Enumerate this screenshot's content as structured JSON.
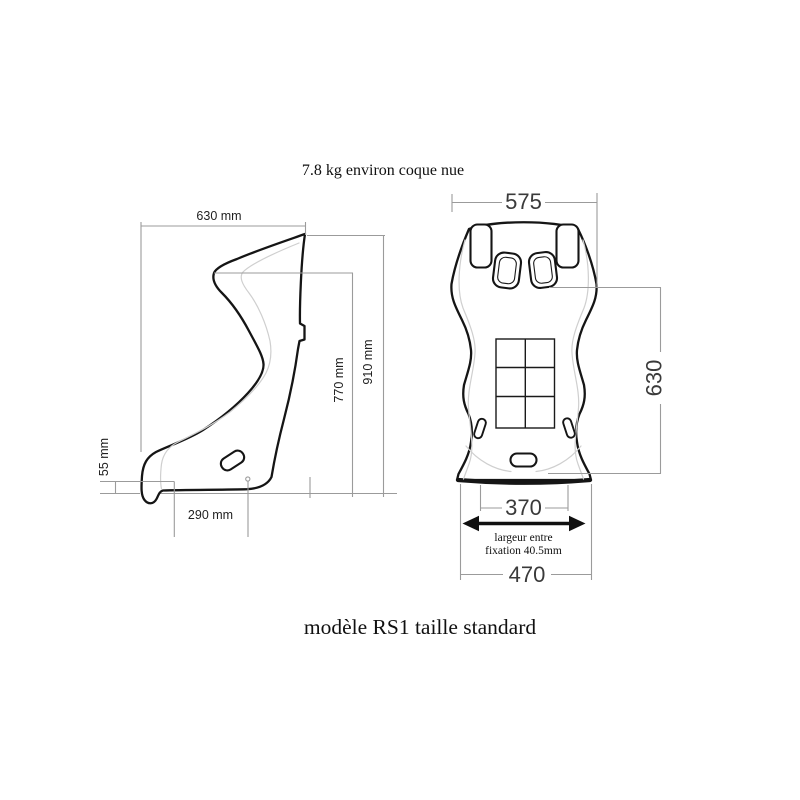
{
  "annotations": {
    "weight_note": "7.8 kg environ coque nue",
    "model_caption": "modèle RS1 taille standard",
    "fixation_note_line1": "largeur entre",
    "fixation_note_line2": "fixation 40.5mm"
  },
  "side_view": {
    "dim_overall_width": "630 mm",
    "dim_overall_height": "910 mm",
    "dim_backrest_height": "770 mm",
    "dim_base_height": "55 mm",
    "dim_base_depth": "290 mm"
  },
  "front_view": {
    "dim_shoulder_width": "575",
    "dim_backrest_height": "630",
    "dim_fixation_width": "370",
    "dim_base_width": "470"
  },
  "colors": {
    "background": "#ffffff",
    "seat_outline": "#151515",
    "dimension_lines": "#9b9b9b",
    "dimension_text_small": "#1f1f1f",
    "dimension_text_large": "#3a3a3a",
    "inner_contour": "#cfcfcf",
    "caption_text": "#101010"
  }
}
